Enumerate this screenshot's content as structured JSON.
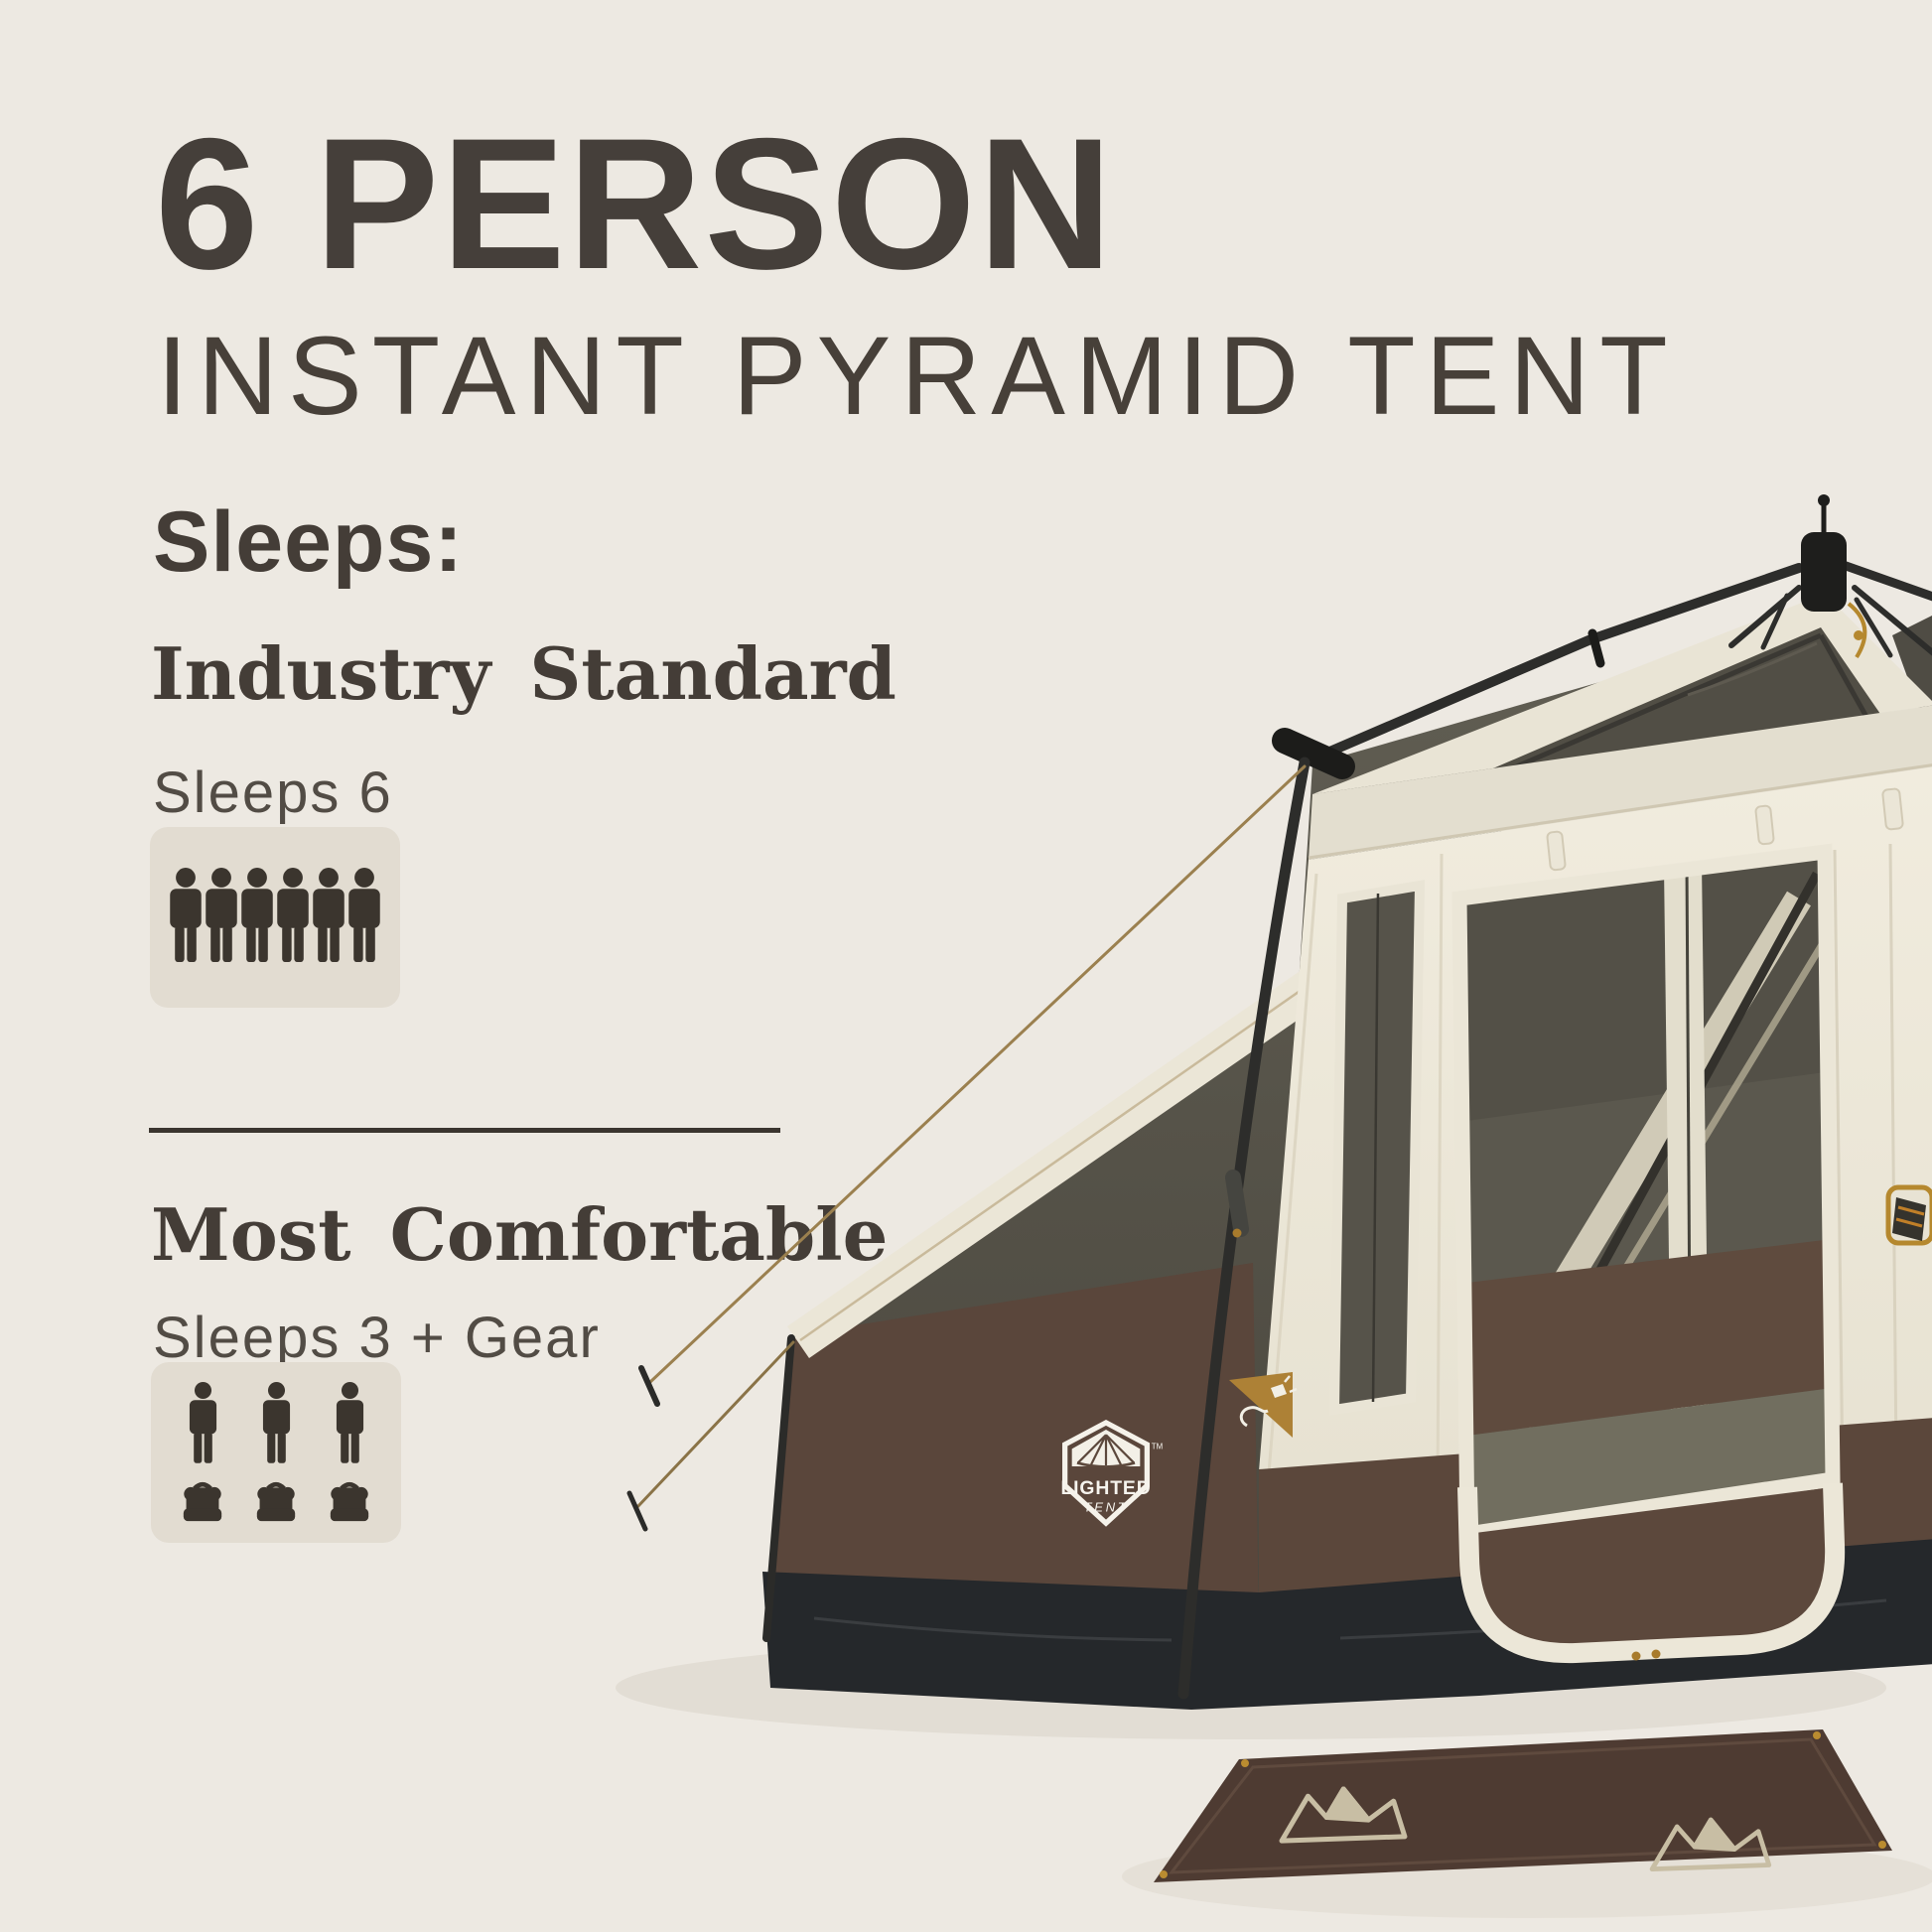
{
  "header": {
    "title": "6 PERSON",
    "subtitle": "INSTANT PYRAMID TENT",
    "sleeps_label": "Sleeps:"
  },
  "sections": [
    {
      "heading": "Industry Standard",
      "capacity_text": "Sleeps 6",
      "person_count": 6,
      "gear_count": 0
    },
    {
      "heading": "Most Comfortable",
      "capacity_text": "Sleeps 3 + Gear",
      "person_count": 3,
      "gear_count": 3
    }
  ],
  "tent_badge": {
    "primary": "LIGHTED",
    "secondary": "TENT",
    "trademark": "TM"
  },
  "colors": {
    "page_background": "#ede9e2",
    "heading_text": "#453f3a",
    "body_text": "#524c45",
    "divider": "#3b352f",
    "icon": "#3b352e",
    "icon_box_background": "#e2dcd1",
    "tent_cream": "#ece7d8",
    "tent_mesh": "#56534a",
    "tent_brown": "#5a463b",
    "tent_skirt": "#25282b",
    "tent_pole": "#2d2d2b",
    "badge_white": "#f4f1e9",
    "gold_accent": "#ad8136",
    "mat_brown": "#4e3b32",
    "mat_pattern": "#c8bea4"
  }
}
